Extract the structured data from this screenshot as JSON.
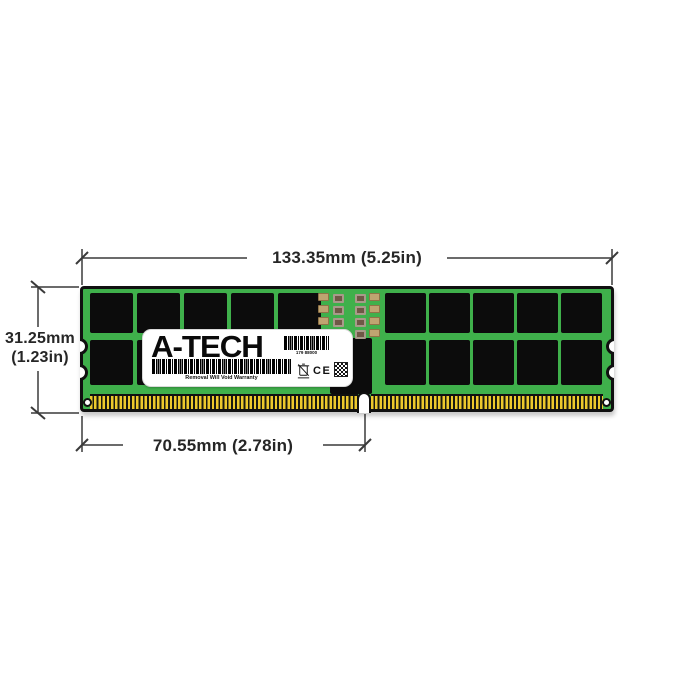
{
  "annotations": {
    "width_label": "133.35mm (5.25in)",
    "height_label_line1": "31.25mm",
    "height_label_line2": "(1.23in)",
    "pin_offset_label": "70.55mm (2.78in)"
  },
  "product_label": {
    "brand": "A-TECH",
    "serial": "179 88000",
    "warranty": "Removal Will Void Warranty",
    "ce_mark": "CE"
  },
  "colors": {
    "pcb_green": "#3fb04b",
    "chip_black": "#0c0c0c",
    "pin_gold": "#edc92c",
    "dimension_line": "#3a3a3a"
  }
}
